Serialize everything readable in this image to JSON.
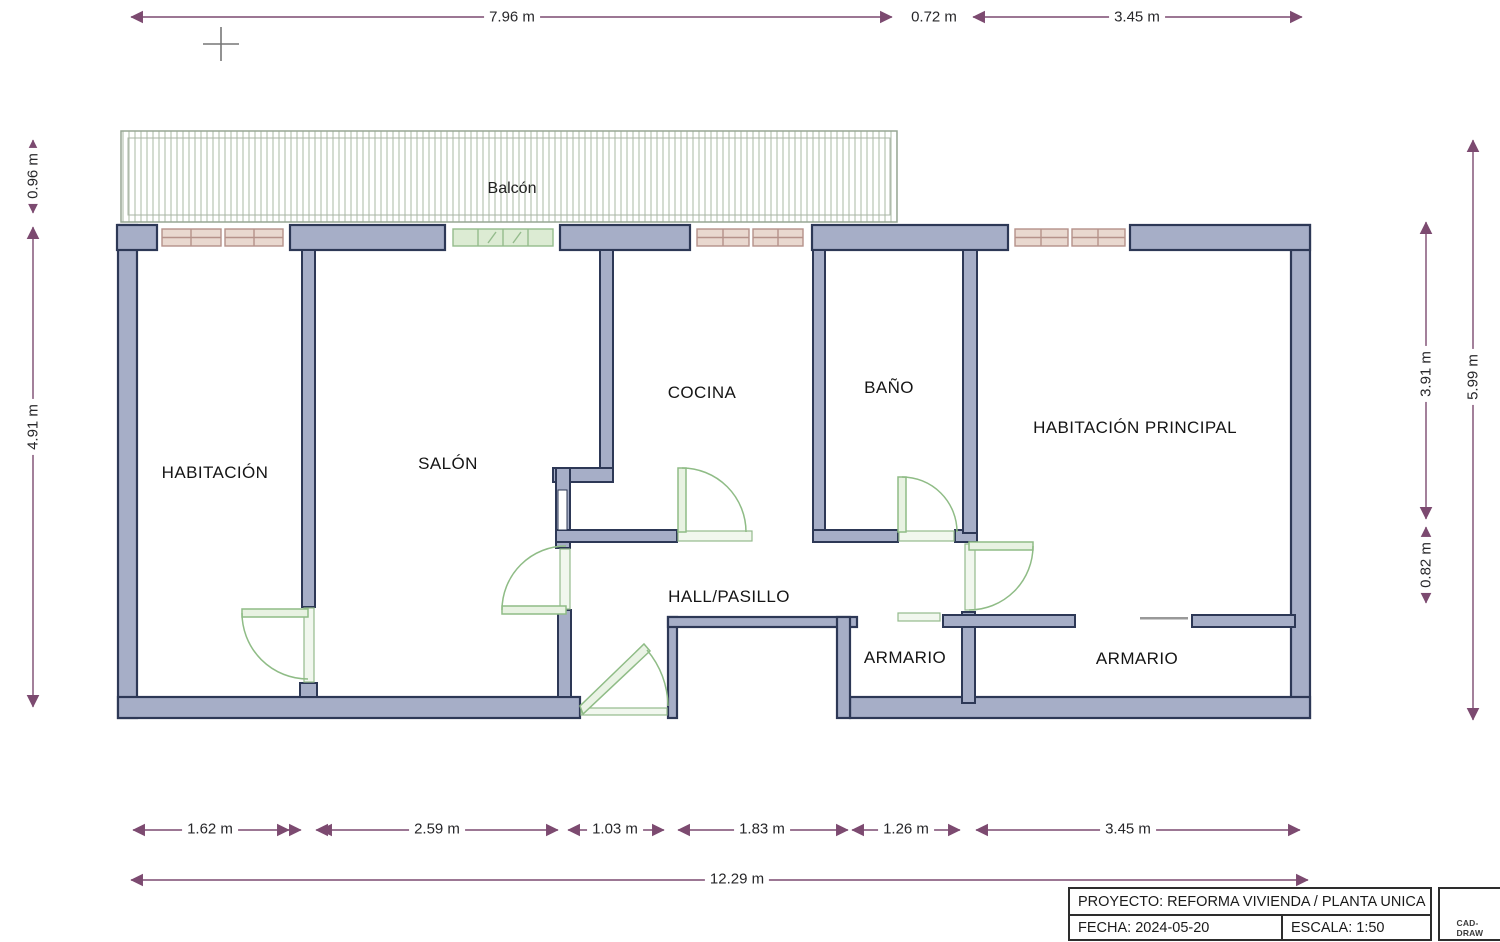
{
  "plan": {
    "balcony": {
      "label": "Balcón"
    },
    "rooms": [
      {
        "id": "habitacion",
        "label": "HABITACIÓN"
      },
      {
        "id": "salon",
        "label": "SALÓN"
      },
      {
        "id": "cocina",
        "label": "COCINA"
      },
      {
        "id": "bano",
        "label": "BAÑO"
      },
      {
        "id": "habitacion-principal",
        "label": "HABITACIÓN PRINCIPAL"
      },
      {
        "id": "hall-pasillo",
        "label": "HALL/PASILLO"
      },
      {
        "id": "armario-1",
        "label": "ARMARIO"
      },
      {
        "id": "armario-2",
        "label": "ARMARIO"
      }
    ]
  },
  "dimensions": {
    "top": [
      "7.96 m",
      "0.72 m",
      "3.45 m"
    ],
    "left": [
      "0.96 m",
      "4.91 m"
    ],
    "right_inner": [
      "3.91 m",
      "0.82 m"
    ],
    "right_outer": "5.99 m",
    "bottom": [
      "1.62 m",
      "2.59 m",
      "1.03 m",
      "1.83 m",
      "1.26 m",
      "3.45 m"
    ],
    "bottom_total": "12.29 m"
  },
  "title_block": {
    "project": "PROYECTO: REFORMA VIVIENDA / PLANTA UNICA",
    "date": "FECHA: 2024-05-20",
    "scale": "ESCALA: 1:50",
    "logo_text": "CAD-DRAW"
  },
  "colors": {
    "wall_fill": "#a6aec7",
    "wall_stroke": "#2d3856",
    "dimension": "#7c4a70",
    "door": "#8fbc86",
    "window_pink_fill": "#e9d8cf",
    "window_pink_stroke": "#b5928a",
    "window_green_fill": "#dcebd3",
    "window_green_stroke": "#94bb8c",
    "balcony_hatch": "#b8c4b2"
  }
}
